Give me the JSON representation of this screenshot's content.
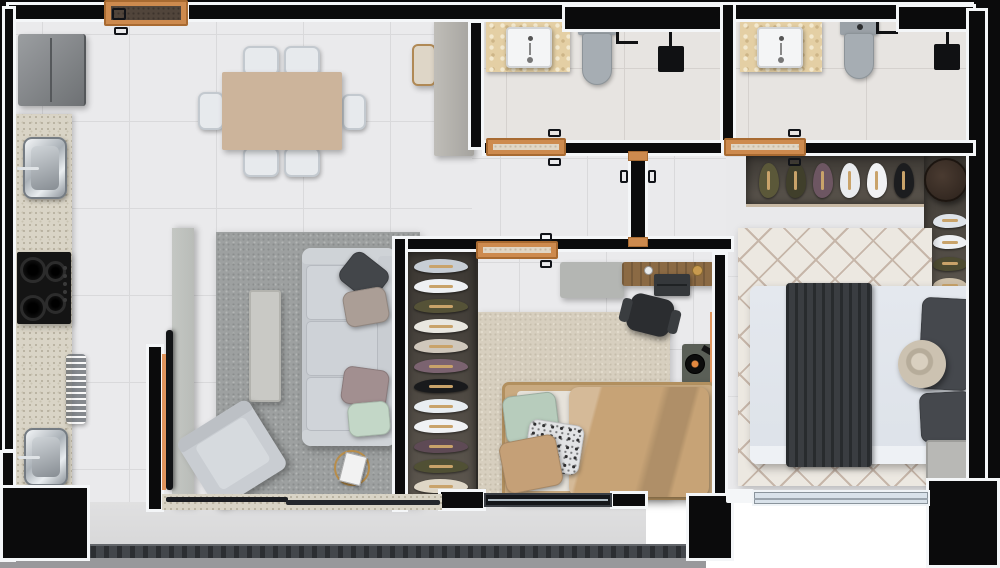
{
  "scene": {
    "kind": "apartment-floor-plan-3d-top-view",
    "rooms": [
      "kitchen",
      "dining-area",
      "living-room",
      "hallway",
      "bathroom-1",
      "bathroom-2",
      "home-office",
      "master-bedroom",
      "balcony"
    ]
  },
  "palette": {
    "wall": "#0b0b0c",
    "lining": "#f4f6f8",
    "wood": "#cd8a4e",
    "floor": "#eaeaec",
    "floor_line": "#d9d9db",
    "bath_floor": "#e7e4e1",
    "granite": "#d9d4c6",
    "marble": "#e4cfa4",
    "rug_ivory": "#ece8e1",
    "rug_lattice": "#c6b6a9",
    "closet_bg": "#5d574f",
    "closet_dark": "#3c3833",
    "hanger": "#c9a36a",
    "accent_orange": "#e0945c",
    "panel": "#b9bcb8",
    "tv": "#121416",
    "railing": "#43464b",
    "ledge": "#98989b",
    "balcony_floor": "#d7d7d8"
  },
  "kitchen": {
    "refrigerator": "#84878a",
    "cooktop": "#141414",
    "sink": "#c7ccd0"
  },
  "dining": {
    "table_top": "#ccb49b",
    "chair": "#e7eaed",
    "chair_count": 6,
    "sideboard": "#b2b0ab",
    "bench": "#ded6c7"
  },
  "living": {
    "sofa": "#c5c9ce",
    "sofa_pillows": [
      "#43464a",
      "#ab9e96",
      "#a28f90",
      "#c3d7c7"
    ],
    "armchair": "#c9cdd2",
    "coffee_table": "#c9c9c5",
    "side_table_gold": "#b88d4a"
  },
  "office": {
    "desk_gray": "#b4b6b3",
    "desk_wood": "#8b6a44",
    "laptop": "#35383b",
    "chair": "#2b2d30",
    "turntable_box": "#5a5f57",
    "turntable_dot": "#e2883f",
    "daybed_frame": "#c9aa80",
    "daybed_duvet": "#c7a376",
    "daybed_pillows": [
      "#b7ccbc",
      "floral",
      "#c5a077"
    ],
    "wardrobe_rack": [
      "#c7cdd4",
      "#eef0f3",
      "#555237",
      "#e9e7e0",
      "#cfc7bb",
      "#7b6370",
      "#191a1c",
      "#e8edf1",
      "#f0f2f4",
      "#5e4a55",
      "#505034",
      "#ded6c6"
    ]
  },
  "bedroom": {
    "duvet": "#dde2e9",
    "runner": "#3a3d41",
    "pillow": "#45484d",
    "pouf": "#c9bfae",
    "nightstand": "#b8b8b5",
    "round_table": "#3a2e25",
    "shelf_items": [
      "#5b5839",
      "#403f2b",
      "#6d5662",
      "#e9ebee",
      "#f1f2f4",
      "#1c1d1f"
    ],
    "rack_items": [
      "#dfe4ea",
      "#eef0f3",
      "#4d4b31",
      "#cec0a9"
    ]
  },
  "bathrooms": {
    "sink": "#f4f5f6",
    "toilet": "#9aa2a8",
    "fixture": "#101113"
  }
}
